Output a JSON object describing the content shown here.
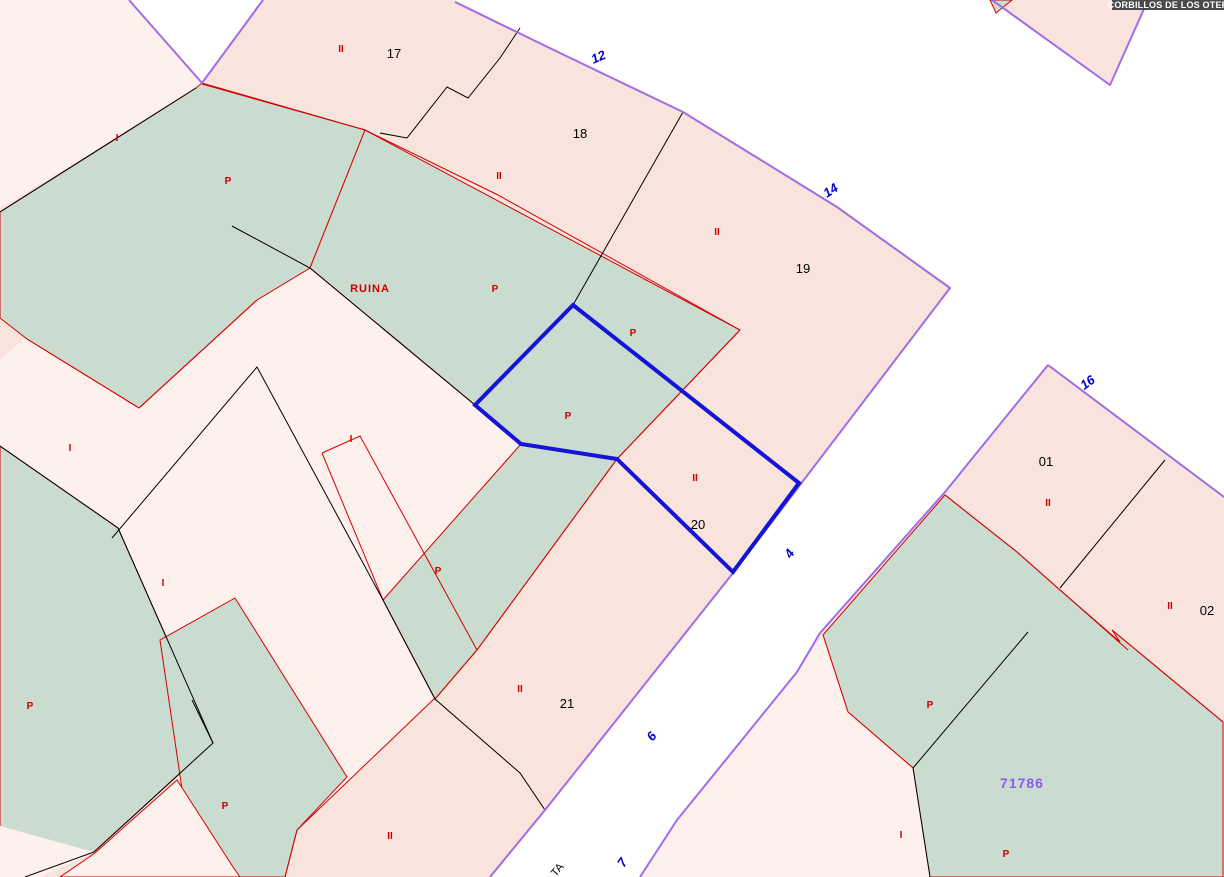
{
  "tooltip": {
    "text": "CORBILLOS DE LOS OTER"
  },
  "colors": {
    "pink": "#F8E3DD",
    "light_pink": "#FDF0ED",
    "green": "#C9DCCF",
    "street_white": "#FFFFFF",
    "purple": "#A06CE8",
    "red_line": "#D40000",
    "red_label": "#CC0000",
    "black_line": "#000000",
    "blue_selection": "#1414D8",
    "blue_number": "#0000CC",
    "violet_number": "#8A5CE8",
    "tooltip_bg": "#4A4A4A",
    "tooltip_text": "#FFFFFF"
  },
  "parcel_numbers": [
    {
      "t": "17"
    },
    {
      "t": "18"
    },
    {
      "t": "19"
    },
    {
      "t": "20"
    },
    {
      "t": "21"
    },
    {
      "t": "01"
    },
    {
      "t": "02"
    }
  ],
  "street_numbers": [
    {
      "t": "12"
    },
    {
      "t": "14"
    },
    {
      "t": "16"
    },
    {
      "t": "4"
    },
    {
      "t": "6"
    },
    {
      "t": "7"
    }
  ],
  "block_numbers": [
    {
      "t": "71786"
    }
  ],
  "use_labels": [
    {
      "t": "II"
    },
    {
      "t": "I"
    },
    {
      "t": "P"
    },
    {
      "t": "II"
    },
    {
      "t": "P"
    },
    {
      "t": "II"
    },
    {
      "t": "P"
    },
    {
      "t": "P"
    },
    {
      "t": "I"
    },
    {
      "t": "I"
    },
    {
      "t": "II"
    },
    {
      "t": "P"
    },
    {
      "t": "I"
    },
    {
      "t": "II"
    },
    {
      "t": "II"
    },
    {
      "t": "P"
    },
    {
      "t": "II"
    },
    {
      "t": "P"
    },
    {
      "t": "P"
    },
    {
      "t": "II"
    },
    {
      "t": "I"
    },
    {
      "t": "P"
    }
  ],
  "special_labels": [
    {
      "t": "RUINA"
    }
  ],
  "street_name_fragment": {
    "t": "TA"
  }
}
